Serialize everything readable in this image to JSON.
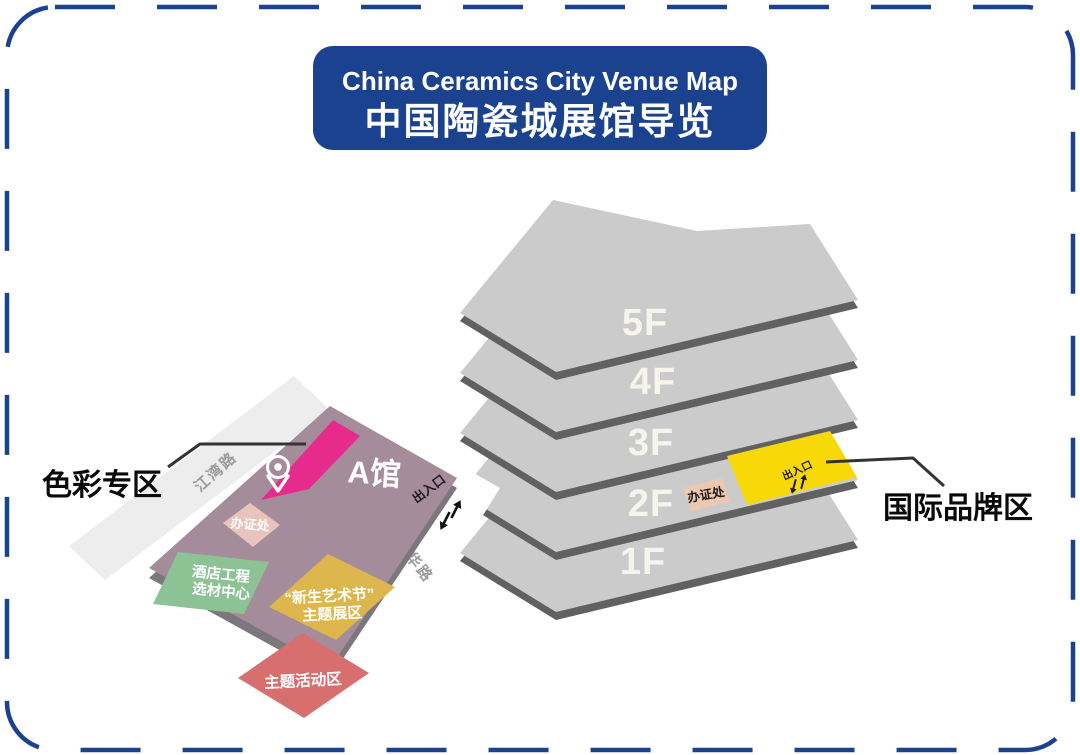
{
  "title": {
    "en": "China Ceramics City Venue Map",
    "zh": "中国陶瓷城展馆导览"
  },
  "tower": {
    "floors": [
      {
        "label": "5F"
      },
      {
        "label": "4F"
      },
      {
        "label": "3F"
      },
      {
        "label": "2F"
      },
      {
        "label": "1F"
      }
    ],
    "floor2": {
      "badge_office": "办证处",
      "entrance": "出入口"
    },
    "callout": "国际品牌区"
  },
  "hall_a": {
    "name": "A馆",
    "entrance": "出入口",
    "badge_office": "办证处",
    "color_zone_callout": "色彩专区",
    "hotel_center_line1": "酒店工程",
    "hotel_center_line2": "选材中心",
    "art_festival_line1": "“新生艺术节”",
    "art_festival_line2": "主题展区",
    "theme_activity": "主题活动区"
  },
  "roads": {
    "jiangwan": "江湾路",
    "jihua": "季华路"
  },
  "icons": {
    "pin": "location-pin",
    "arrows": "two-way-entrance-arrows"
  },
  "colors": {
    "blue": "#1b428f",
    "mauve": "#a58c9b",
    "mauve_edge": "#7c777c",
    "magenta": "#e62b8c",
    "green": "#8dc394",
    "gold": "#ddb64d",
    "red": "#d76f6e",
    "bright_yellow": "#f8d908",
    "peach": "#ecc9ae",
    "pink_peach": "#e8c4bc",
    "plate_gray": "#cbcbcb",
    "plate_edge": "#616161",
    "road_gray": "#ededed",
    "road_text": "#9b9b9b",
    "label_cream": "#f5f5ec",
    "text_dark": "#1a1a1a"
  }
}
